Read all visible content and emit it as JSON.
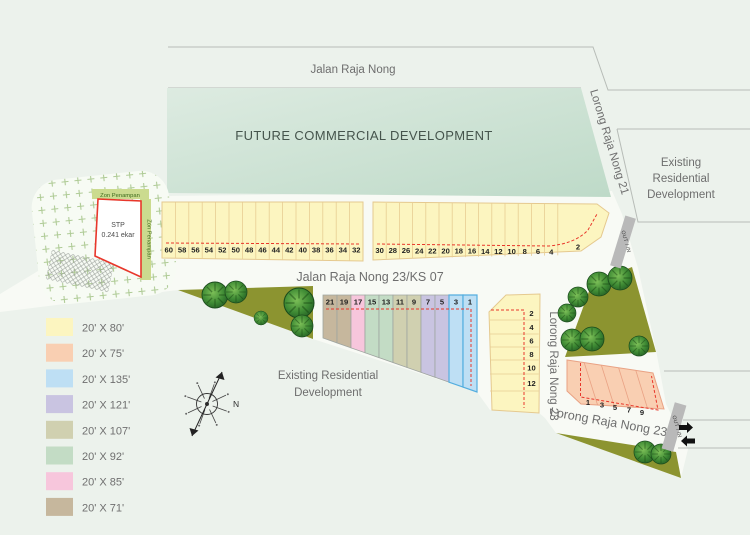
{
  "map": {
    "background": "#ECF2EC",
    "road_fill": "#F8FAF5",
    "roads": {
      "top": "Jalan Raja Nong",
      "diag_right": "Lorong Raja Nong 21",
      "middle": "Jalan Raja Nong 23/KS 07",
      "vertical_right": "Lorong Raja Nong 23",
      "bottom_diag": "Lorong Raja Nong 23"
    },
    "areas": {
      "future_commercial": "FUTURE COMMERCIAL DEVELOPMENT",
      "existing_right_lines": [
        "Existing",
        "Residential",
        "Development"
      ],
      "existing_left_lines": [
        "Existing Residential",
        "Development"
      ],
      "stp_lines": [
        "STP",
        "0.241 ekar"
      ],
      "buffer_top": "Zon Penampan",
      "buffer_right": "Zon Penampan"
    },
    "markers": {
      "gate": "OUT / IN",
      "north": "N"
    },
    "colors": {
      "yellow": "#FCF5C0",
      "salmon": "#F9CFB2",
      "blue": "#BEDFF4",
      "lavender": "#C9C4E1",
      "khaki": "#D0D0B0",
      "green": "#C3DCC5",
      "pink": "#F7C6DC",
      "tan": "#C6B79D",
      "olive": "#8C9430",
      "red_dash": "#E8372B"
    },
    "lots": {
      "row_top_left": [
        "60",
        "58",
        "56",
        "54",
        "52",
        "50",
        "48",
        "46",
        "44",
        "42",
        "40",
        "38",
        "36",
        "34",
        "32"
      ],
      "row_top_right": [
        "30",
        "28",
        "26",
        "24",
        "22",
        "20",
        "18",
        "16",
        "14",
        "12",
        "10",
        "8",
        "6",
        "4",
        "2"
      ],
      "row_mid": {
        "numbers": [
          "21",
          "19",
          "17",
          "15",
          "13",
          "11",
          "9",
          "7",
          "5",
          "3",
          "1"
        ],
        "colors": [
          "tan",
          "tan",
          "pink",
          "green",
          "green",
          "khaki",
          "khaki",
          "lavender",
          "lavender",
          "blue",
          "blue"
        ]
      },
      "block_right": [
        "2",
        "4",
        "6",
        "8",
        "10",
        "12"
      ],
      "block_pink": [
        "1",
        "3",
        "5",
        "7",
        "9"
      ]
    },
    "legend": [
      {
        "label": "20' X 80'",
        "color": "yellow"
      },
      {
        "label": "20' X 75'",
        "color": "salmon"
      },
      {
        "label": "20' X 135'",
        "color": "blue"
      },
      {
        "label": "20' X 121'",
        "color": "lavender"
      },
      {
        "label": "20' X 107'",
        "color": "khaki"
      },
      {
        "label": "20' X 92'",
        "color": "green"
      },
      {
        "label": "20' X 85'",
        "color": "pink"
      },
      {
        "label": "20' X 71'",
        "color": "tan"
      }
    ]
  }
}
